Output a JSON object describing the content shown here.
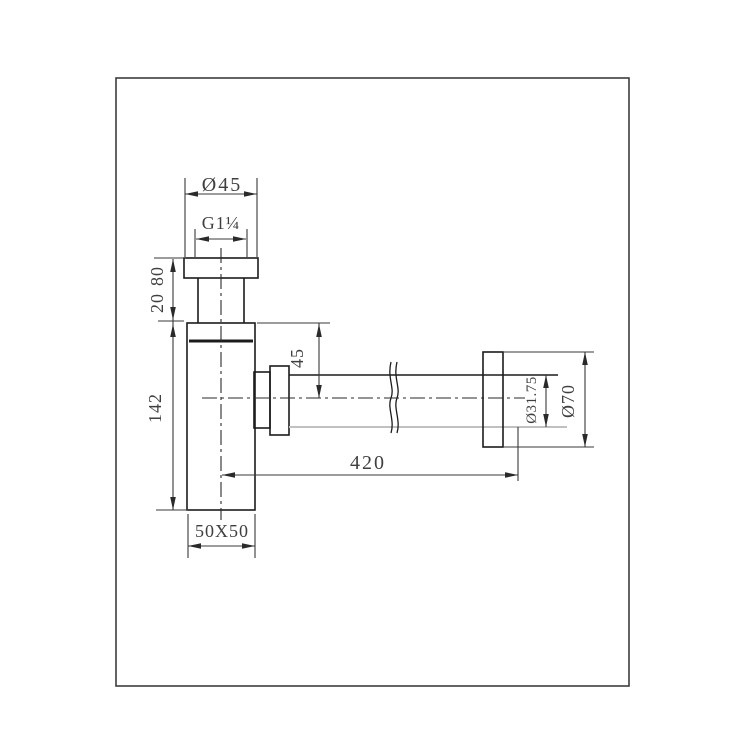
{
  "drawing": {
    "dimensions": {
      "top_diameter": "Ø45",
      "thread_size": "G1¼",
      "inlet_height": "80",
      "flange_thickness": "20",
      "body_height": "142",
      "outlet_drop": "45",
      "pipe_length": "420",
      "pipe_diameter": "Ø31.75",
      "wall_flange_diameter": "Ø70",
      "body_section": "50X50"
    },
    "colors": {
      "outline": "#1c1c1c",
      "dimension_lines": "#3a3a3a",
      "light_line": "#c0c0c0",
      "text": "#3f3f3f",
      "background": "#ffffff"
    }
  }
}
